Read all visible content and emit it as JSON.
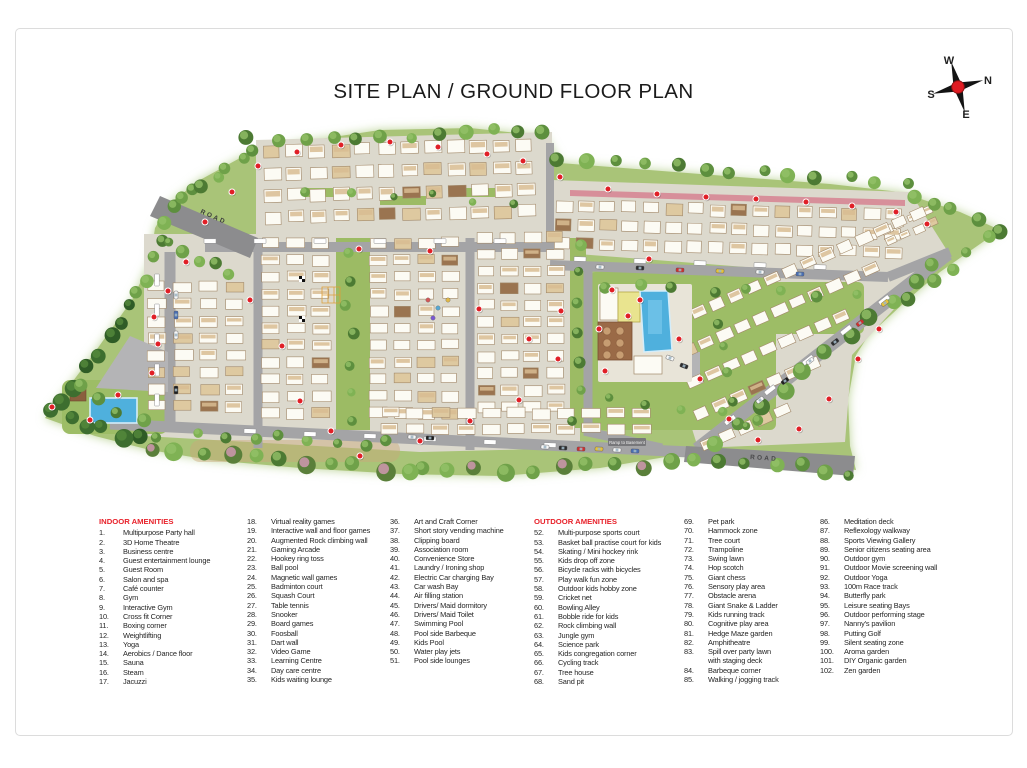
{
  "page": {
    "title": "SITE PLAN / GROUND FLOOR PLAN"
  },
  "compass": {
    "north": "N",
    "south": "S",
    "east": "E",
    "west": "W"
  },
  "map_labels": {
    "road_top_left": "ROAD",
    "road_bottom_right": "ROAD",
    "ramp": "Ramp to Basement"
  },
  "colors": {
    "legend_header": "#e8212a",
    "marker_red": "#e01f26",
    "pool_blue": "#4fb0dd",
    "lawn_green": "#a9c478",
    "road_gray": "#a4a4a6"
  },
  "legend": {
    "columns": [
      {
        "header": "INDOOR AMENITIES",
        "items": [
          {
            "n": "1.",
            "t": "Multipurpose Party hall"
          },
          {
            "n": "2.",
            "t": "3D Home Theatre"
          },
          {
            "n": "3.",
            "t": "Business centre"
          },
          {
            "n": "4.",
            "t": "Guest entertainment lounge"
          },
          {
            "n": "5.",
            "t": "Guest Room"
          },
          {
            "n": "6.",
            "t": "Salon and spa"
          },
          {
            "n": "7.",
            "t": "Café counter"
          },
          {
            "n": "8.",
            "t": "Gym"
          },
          {
            "n": "9.",
            "t": "Interactive Gym"
          },
          {
            "n": "10.",
            "t": "Cross fit Corner"
          },
          {
            "n": "11.",
            "t": "Boxing corner"
          },
          {
            "n": "12.",
            "t": "Weightlifting"
          },
          {
            "n": "13.",
            "t": "Yoga"
          },
          {
            "n": "14.",
            "t": "Aerobics / Dance floor"
          },
          {
            "n": "15.",
            "t": "Sauna"
          },
          {
            "n": "16.",
            "t": "Steam"
          },
          {
            "n": "17.",
            "t": "Jacuzzi"
          }
        ]
      },
      {
        "items": [
          {
            "n": "18.",
            "t": "Virtual reality games"
          },
          {
            "n": "19.",
            "t": "Interactive wall and floor games"
          },
          {
            "n": "20.",
            "t": "Augmented Rock climbing wall"
          },
          {
            "n": "21.",
            "t": "Gaming Arcade"
          },
          {
            "n": "22.",
            "t": "Hookey ring toss"
          },
          {
            "n": "23.",
            "t": "Ball pool"
          },
          {
            "n": "24.",
            "t": "Magnetic wall games"
          },
          {
            "n": "25.",
            "t": "Badminton court"
          },
          {
            "n": "26.",
            "t": "Squash Court"
          },
          {
            "n": "27.",
            "t": "Table tennis"
          },
          {
            "n": "28.",
            "t": "Snooker"
          },
          {
            "n": "29.",
            "t": "Board games"
          },
          {
            "n": "30.",
            "t": "Foosball"
          },
          {
            "n": "31.",
            "t": "Dart wall"
          },
          {
            "n": "32.",
            "t": "Video Game"
          },
          {
            "n": "33.",
            "t": "Learning Centre"
          },
          {
            "n": "34.",
            "t": "Day care centre"
          },
          {
            "n": "35.",
            "t": "Kids waiting lounge"
          }
        ]
      },
      {
        "items": [
          {
            "n": "36.",
            "t": "Art and Craft Corner"
          },
          {
            "n": "37.",
            "t": "Short story vending machine"
          },
          {
            "n": "38.",
            "t": "Clipping board"
          },
          {
            "n": "39.",
            "t": "Association room"
          },
          {
            "n": "40.",
            "t": "Convenience Store"
          },
          {
            "n": "41.",
            "t": "Laundry / Ironing shop"
          },
          {
            "n": "42.",
            "t": "Electric Car charging Bay"
          },
          {
            "n": "43.",
            "t": "Car wash Bay"
          },
          {
            "n": "44.",
            "t": "Air filling station"
          },
          {
            "n": "45.",
            "t": "Drivers/ Maid dormitory"
          },
          {
            "n": "46.",
            "t": "Drivers/ Maid Toilet"
          },
          {
            "n": "47.",
            "t": "Swimming Pool"
          },
          {
            "n": "48.",
            "t": "Pool side Barbeque"
          },
          {
            "n": "49.",
            "t": "Kids Pool"
          },
          {
            "n": "50.",
            "t": "Water play jets"
          },
          {
            "n": "51.",
            "t": "Pool side lounges"
          }
        ]
      },
      {
        "header": "OUTDOOR AMENITIES",
        "items": [
          {
            "n": "52.",
            "t": "Multi-purpose sports court"
          },
          {
            "n": "53.",
            "t": "Basket ball practise court for kids"
          },
          {
            "n": "54.",
            "t": "Skating / Mini hockey rink"
          },
          {
            "n": "55.",
            "t": "Kids drop off zone"
          },
          {
            "n": "56.",
            "t": "Bicycle racks with bicycles"
          },
          {
            "n": "57.",
            "t": "Play walk fun zone"
          },
          {
            "n": "58.",
            "t": "Outdoor kids hobby zone"
          },
          {
            "n": "59.",
            "t": "Cricket net"
          },
          {
            "n": "60.",
            "t": "Bowling Alley"
          },
          {
            "n": "61.",
            "t": "Bobble ride for kids"
          },
          {
            "n": "62.",
            "t": "Rock climbing wall"
          },
          {
            "n": "63.",
            "t": "Jungle gym"
          },
          {
            "n": "64.",
            "t": "Science park"
          },
          {
            "n": "65.",
            "t": "Kids congregation corner"
          },
          {
            "n": "66.",
            "t": "Cycling track"
          },
          {
            "n": "67.",
            "t": "Tree house"
          },
          {
            "n": "68.",
            "t": "Sand pit"
          }
        ]
      },
      {
        "items": [
          {
            "n": "69.",
            "t": "Pet park"
          },
          {
            "n": "70.",
            "t": "Hammock zone"
          },
          {
            "n": "71.",
            "t": "Tree court"
          },
          {
            "n": "72.",
            "t": "Trampoline"
          },
          {
            "n": "73.",
            "t": "Swing lawn"
          },
          {
            "n": "74.",
            "t": "Hop scotch"
          },
          {
            "n": "75.",
            "t": "Giant chess"
          },
          {
            "n": "76.",
            "t": "Sensory play area"
          },
          {
            "n": "77.",
            "t": "Obstacle arena"
          },
          {
            "n": "78.",
            "t": "Giant Snake & Ladder"
          },
          {
            "n": "79.",
            "t": "Kids running track"
          },
          {
            "n": "80.",
            "t": "Cognitive play area"
          },
          {
            "n": "81.",
            "t": "Hedge Maze garden"
          },
          {
            "n": "82.",
            "t": "Amphitheatre"
          },
          {
            "n": "83.",
            "t": "Spill over party lawn\nwith staging deck"
          },
          {
            "n": "84.",
            "t": "Barbeque corner"
          },
          {
            "n": "85.",
            "t": "Walking / jogging track"
          }
        ]
      },
      {
        "items": [
          {
            "n": "86.",
            "t": "Meditation deck"
          },
          {
            "n": "87.",
            "t": "Reflexology walkway"
          },
          {
            "n": "88.",
            "t": "Sports Viewing Gallery"
          },
          {
            "n": "89.",
            "t": "Senior citizens seating area"
          },
          {
            "n": "90.",
            "t": "Outdoor gym"
          },
          {
            "n": "91.",
            "t": "Outdoor Movie screening wall"
          },
          {
            "n": "92.",
            "t": "Outdoor Yoga"
          },
          {
            "n": "93.",
            "t": "100m Race track"
          },
          {
            "n": "94.",
            "t": "Butterfly park"
          },
          {
            "n": "95.",
            "t": "Leisure seating Bays"
          },
          {
            "n": "96.",
            "t": "Outdoor performing stage"
          },
          {
            "n": "97.",
            "t": "Nanny's pavilion"
          },
          {
            "n": "98.",
            "t": "Putting Golf"
          },
          {
            "n": "99.",
            "t": "Silent seating zone"
          },
          {
            "n": "100.",
            "t": "Aroma garden"
          },
          {
            "n": "101.",
            "t": "DIY Organic garden"
          },
          {
            "n": "102.",
            "t": "Zen garden"
          }
        ]
      }
    ]
  }
}
